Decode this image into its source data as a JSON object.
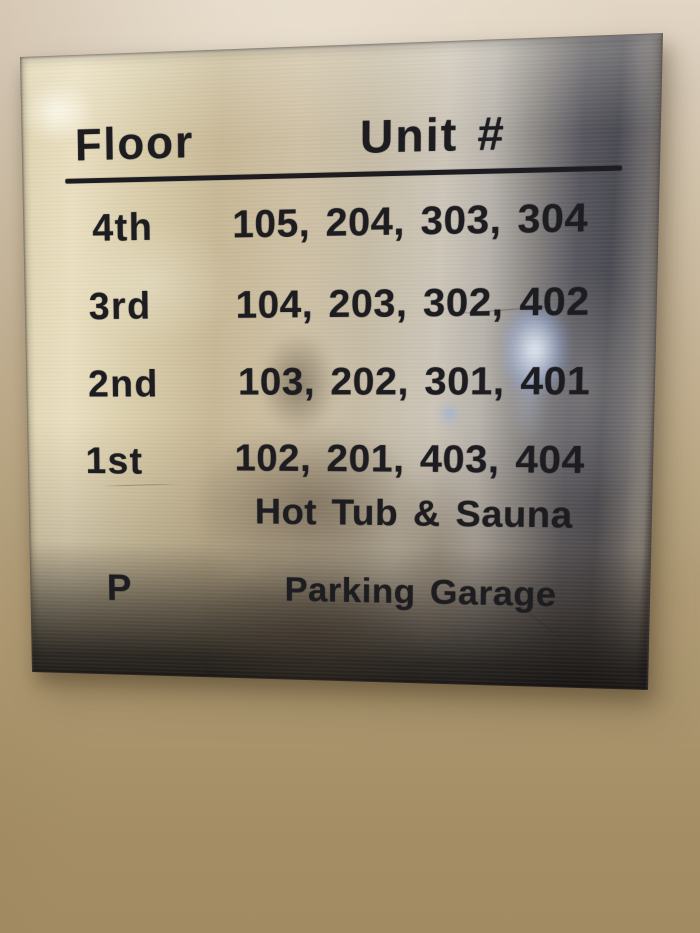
{
  "scene": {
    "description": "Photo of a brushed stainless-steel building directory sign mounted on a beige painted wall"
  },
  "sign": {
    "header": {
      "floor_col": "Floor",
      "unit_col": "Unit #"
    },
    "rows": [
      {
        "floor": "4th",
        "units": "105, 204, 303, 304"
      },
      {
        "floor": "3rd",
        "units": "104, 203, 302, 402"
      },
      {
        "floor": "2nd",
        "units": "103, 202, 301, 401"
      },
      {
        "floor": "1st",
        "units": "102, 201, 403, 404"
      },
      {
        "floor": "",
        "units": "Hot Tub & Sauna"
      },
      {
        "floor": "P",
        "units": "Parking Garage"
      }
    ],
    "colors": {
      "text": "#1d1c20",
      "plate_highlight": "#eadfc0",
      "plate_midtone": "#c7b896",
      "plate_dark_band": "#4a4a52",
      "plate_bottom": "#26221e",
      "wall_top": "#e2d5c3",
      "wall_bottom": "#a28b63",
      "reflection_blue": "#9fc0ff"
    }
  }
}
